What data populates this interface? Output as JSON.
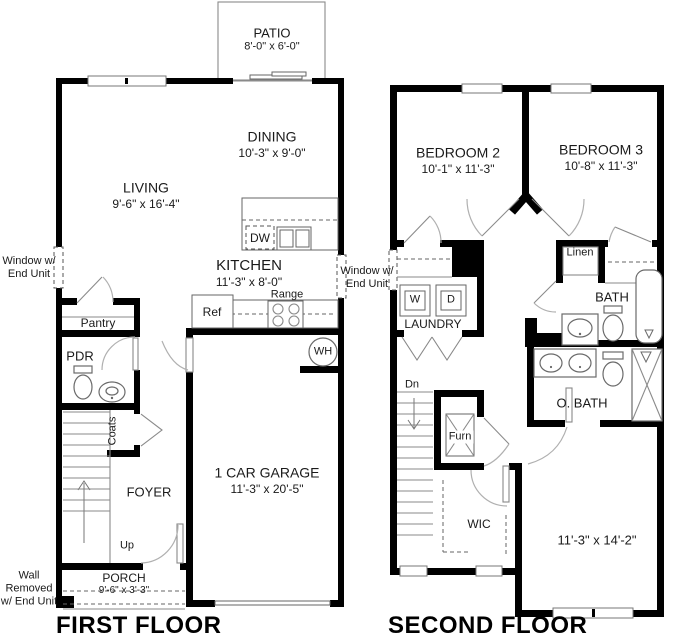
{
  "ff": {
    "title": "FIRST FLOOR",
    "patio": "PATIO",
    "patio_dims": "8'-0\" x 6'-0\"",
    "dining": "DINING",
    "dining_dims": "10'-3\" x 9'-0\"",
    "living": "LIVING",
    "living_dims": "9'-6\" x 16'-4\"",
    "kitchen": "KITCHEN",
    "kitchen_dims": "11'-3\" x 8'-0\"",
    "garage": "1 CAR GARAGE",
    "garage_dims": "11'-3\" x 20'-5\"",
    "porch": "PORCH",
    "porch_dims": "9'-6\" x 3'-3\"",
    "foyer": "FOYER",
    "pantry": "Pantry",
    "pdr": "PDR",
    "coats": "Coats",
    "up": "Up",
    "ref": "Ref",
    "range": "Range",
    "dw": "DW",
    "wh": "WH",
    "window_note": "Window w/ End Unit",
    "wall_removed_note": "Wall Removed w/ End Unit"
  },
  "sf": {
    "title": "SECOND FLOOR",
    "bedroom2": "BEDROOM 2",
    "bedroom2_dims": "10'-1\" x 11'-3\"",
    "bedroom3": "BEDROOM 3",
    "bedroom3_dims": "10'-8\" x 11'-3\"",
    "owner_dims": "11'-3\" x 14'-2\"",
    "laundry": "LAUNDRY",
    "washer": "W",
    "dryer": "D",
    "bath": "BATH",
    "owner_bath": "O. BATH",
    "wic": "WIC",
    "linen": "Linen",
    "furn": "Furn",
    "dn": "Dn",
    "window_note": "Window w/ End Unit"
  }
}
